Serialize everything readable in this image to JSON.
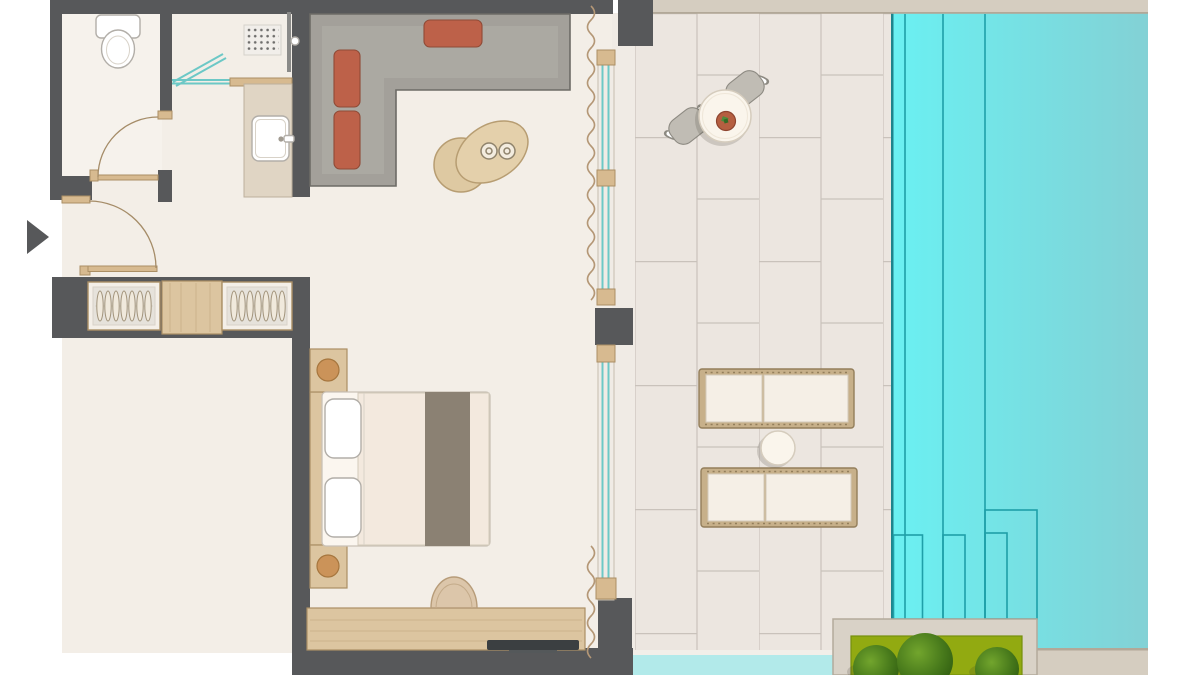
{
  "scene": {
    "type": "architectural-floor-plan",
    "rooms": [
      "toilet-room",
      "shower-room",
      "vanity-area",
      "entry-hall",
      "wardrobe",
      "living-area",
      "bedroom",
      "terrace",
      "pool"
    ],
    "furniture": [
      "toilet",
      "shower-tray",
      "vanity-sink",
      "corner-sofa",
      "coffee-tables",
      "wardrobe-hangers",
      "double-bed",
      "nightstands",
      "desk",
      "desk-chair",
      "tv",
      "bistro-table",
      "bistro-chairs",
      "sun-loungers",
      "side-table",
      "planter-bushes"
    ],
    "counts": {
      "wardrobe_hangers_per_section": 7,
      "sofa_cushions": 3,
      "bed_pillows": 2,
      "sun_loungers": 2,
      "bistro_chairs": 2,
      "planter_bushes": 3,
      "pool_lane_lines": 3,
      "pool_step_outlines": 4
    },
    "pool": {
      "lane_line_x": [
        905,
        943,
        985
      ]
    }
  },
  "palette": {
    "background": "#ffffff",
    "wall": "#57585a",
    "floor": "#f3eee7",
    "floor_light": "#f6f2ec",
    "tile": "#ece6e0",
    "track": "#f0ebe5",
    "grout": "#c9c2bb",
    "deck": "#d5cdc0",
    "deck_shadow": "#b2a898",
    "channel": "#b2eaea",
    "channel_lip": "#f2efe9",
    "pool_left": "#6af0f2",
    "pool_right": "#83d1d5",
    "pool_line": "#1f9fa8",
    "pool_edge": "#1d858d",
    "glass_teal": "#6cc8c6",
    "curtain": "#b49776",
    "wood": "#dcc5a0",
    "wood_dark": "#ab8f65",
    "door_tan": "#d7ba90",
    "door_arc": "#a58c68",
    "sofa": "#a3a09a",
    "sofa_light": "#b3b0aa",
    "sofa_border": "#6d6b66",
    "cushion": "#bd6149",
    "cushion_border": "#8f4a36",
    "white": "#ffffff",
    "fixture_stroke": "#b2aea8",
    "soft_line": "#d8d2c8",
    "cream": "#f5efe6",
    "cream_stroke": "#d3cabb",
    "lounger_frame": "#c7b08a",
    "lounger_frame_dark": "#937e5b",
    "runner": "#8b8173",
    "duvet": "#f3e9de",
    "tv": "#3b3f41",
    "tv_foot": "#54585a",
    "planter_box": "#d9d2c7",
    "planter_stroke": "#b3aa9b",
    "planter_green": "#92aa11",
    "planter_green_dark": "#76900c",
    "bush_light": "#72a52d",
    "bush_mid": "#47791b",
    "bush_dark": "#2f5c10",
    "chair_seat": "#c0bcb4",
    "chair_stroke": "#8d8a82",
    "table_top": "#faf5ec",
    "table_stroke": "#d5ccbd",
    "terracotta": "#b55f41",
    "terracotta_dark": "#8e4530",
    "leaf_green": "#4f8c3c",
    "leaf_dark": "#356b26",
    "hanger_fill": "#f0e9dc",
    "hanger_stroke": "#a2947c",
    "wardrobe_box": "#f4efe8",
    "wardrobe_inner": "#e6e2db",
    "shower_panel": "#8a8a88",
    "bowl_fill": "#f3ecdf",
    "bowl_stroke": "#8f836c"
  }
}
